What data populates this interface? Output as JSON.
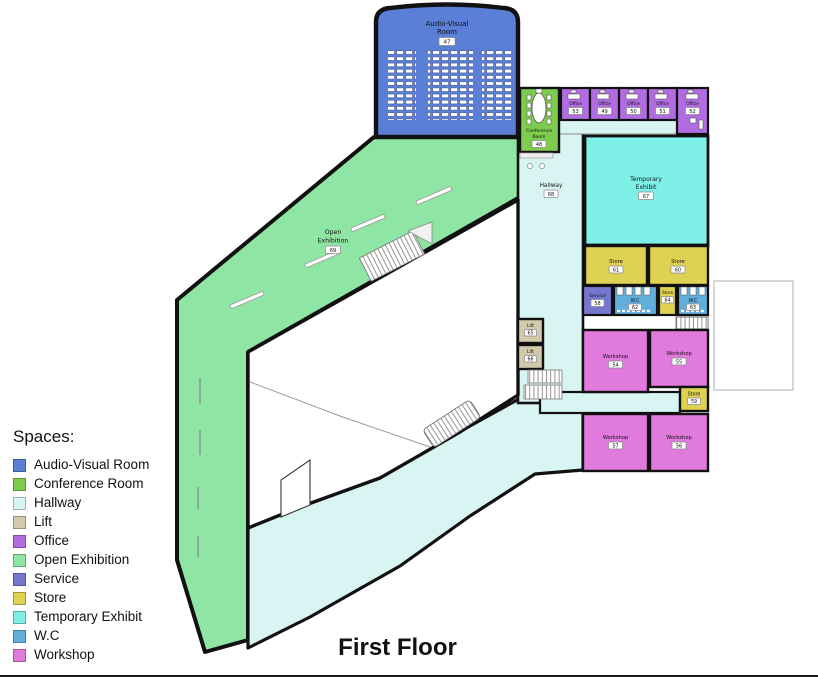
{
  "title": "First Floor",
  "legend": {
    "title": "Spaces:",
    "items": [
      {
        "label": "Audio-Visual Room",
        "color": "#5b7fd6"
      },
      {
        "label": "Conference Room",
        "color": "#7ecc4e"
      },
      {
        "label": "Hallway",
        "color": "#d9f5f3"
      },
      {
        "label": "Lift",
        "color": "#d3c9ac"
      },
      {
        "label": "Office",
        "color": "#b06ce0"
      },
      {
        "label": "Open Exhibition",
        "color": "#8fe6a4"
      },
      {
        "label": "Service",
        "color": "#7577cf"
      },
      {
        "label": "Store",
        "color": "#dfd253"
      },
      {
        "label": "Temporary Exhibit",
        "color": "#7ff0e8"
      },
      {
        "label": "W.C",
        "color": "#62aeda"
      },
      {
        "label": "Workshop",
        "color": "#e07adc"
      }
    ]
  },
  "colors": {
    "av": "#5b7fd6",
    "conference": "#7ecc4e",
    "hallway": "#d9f5f3",
    "lift": "#d3c9ac",
    "office": "#b06ce0",
    "open": "#8fe6a4",
    "service": "#7577cf",
    "store": "#dfd253",
    "temp": "#7ff0e8",
    "wc": "#62aeda",
    "workshop": "#e07adc"
  },
  "rooms": {
    "audio_visual": {
      "line1": "Audio-Visual",
      "line2": "Room",
      "number": "47"
    },
    "conference": {
      "line1": "Conference",
      "line2": "Room",
      "number": "48"
    },
    "office53": {
      "label": "Office",
      "number": "53"
    },
    "office49": {
      "label": "Office",
      "number": "49"
    },
    "office50": {
      "label": "Office",
      "number": "50"
    },
    "office51": {
      "label": "Office",
      "number": "51"
    },
    "office52": {
      "label": "Office",
      "number": "52"
    },
    "hallway68": {
      "label": "Hallway",
      "number": "68"
    },
    "temporary_exhibit": {
      "line1": "Temporary",
      "line2": "Exhibit",
      "number": "67"
    },
    "store61": {
      "label": "Store",
      "number": "61"
    },
    "store60": {
      "label": "Store",
      "number": "60"
    },
    "service58": {
      "label": "Service",
      "number": "58"
    },
    "wc62": {
      "label": "W.C",
      "number": "62"
    },
    "store64": {
      "label": "Store",
      "number": "64"
    },
    "wc63": {
      "label": "W.C",
      "number": "63"
    },
    "lift65": {
      "label": "Lift",
      "number": "65"
    },
    "lift66": {
      "label": "Lift",
      "number": "66"
    },
    "workshop54": {
      "label": "Workshop",
      "number": "54"
    },
    "workshop55": {
      "label": "Workshop",
      "number": "55"
    },
    "store59": {
      "label": "Store",
      "number": "59"
    },
    "workshop57": {
      "label": "Workshop",
      "number": "57"
    },
    "workshop56": {
      "label": "Workshop",
      "number": "56"
    },
    "open_exhibition": {
      "line1": "Open",
      "line2": "Exhibition",
      "number": "69"
    }
  }
}
